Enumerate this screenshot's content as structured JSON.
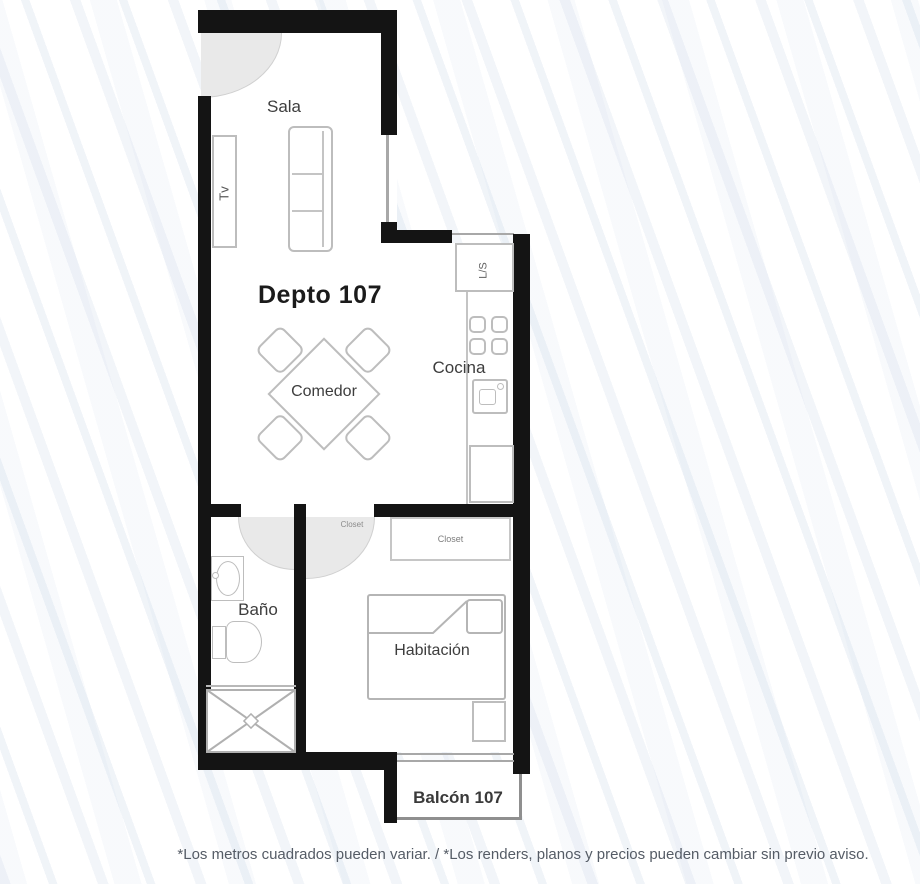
{
  "plan": {
    "title": "Depto 107",
    "rooms": {
      "sala": "Sala",
      "cocina": "Cocina",
      "comedor": "Comedor",
      "bano": "Baño",
      "habitacion": "Habitación",
      "balcon": "Balcón 107"
    },
    "furniture_labels": {
      "tv": "Tv",
      "laundry": "L/S",
      "closet_hall": "Closet",
      "closet_bedroom": "Closet"
    },
    "colors": {
      "wall": "#141414",
      "furniture_line": "#bdbdbd",
      "door_swing_fill": "#e9e9e9",
      "label_text": "#3d3d3d",
      "background_streak": "#d3deee"
    }
  },
  "footer": {
    "disclaimer": "*Los metros cuadrados pueden variar. / *Los renders, planos y precios pueden cambiar sin previo aviso."
  }
}
